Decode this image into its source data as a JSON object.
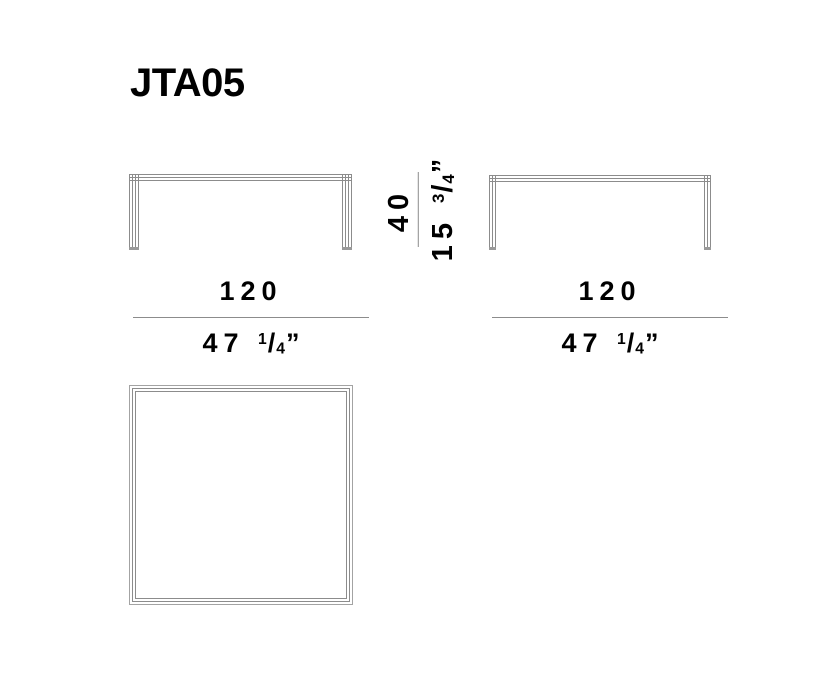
{
  "title": "JTA05",
  "colors": {
    "line_gray": "#8c8c8c",
    "text_black": "#000000",
    "background": "#ffffff"
  },
  "dimensions": {
    "front_width": {
      "cm": "120",
      "inch_whole": "47",
      "frac_num": "1",
      "frac_slash": "/",
      "frac_den": "4",
      "unit_mark": "”"
    },
    "side_width": {
      "cm": "120",
      "inch_whole": "47",
      "frac_num": "1",
      "frac_slash": "/",
      "frac_den": "4",
      "unit_mark": "”"
    },
    "height": {
      "cm": "40",
      "inch_whole": "15",
      "frac_num": "3",
      "frac_slash": "/",
      "frac_den": "4",
      "unit_mark": "”"
    }
  }
}
